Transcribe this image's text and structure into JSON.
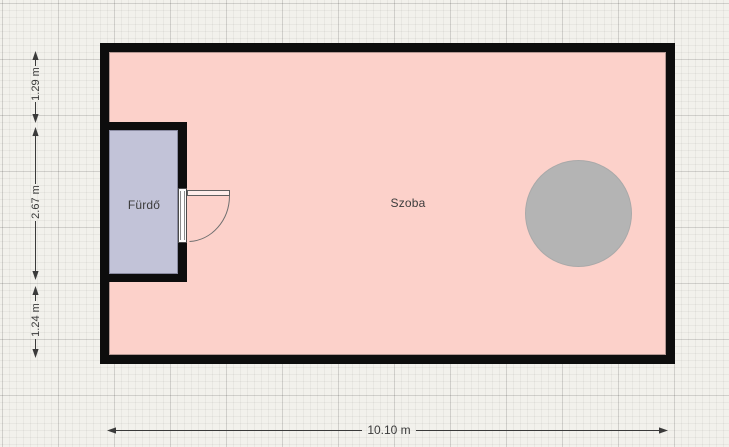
{
  "app": {
    "view": "floor-plan-canvas",
    "unit": "m"
  },
  "rooms": [
    {
      "id": "szoba",
      "label": "Szoba",
      "fill": "#fcd1ca"
    },
    {
      "id": "furdo",
      "label": "Fürdő",
      "fill": "#c2c3d8"
    }
  ],
  "furniture": [
    {
      "id": "round-table",
      "shape": "circle",
      "fill": "#b4b4b4"
    }
  ],
  "doors": [
    {
      "id": "bathroom-door",
      "wall": "bathroom-right-wall",
      "swing": "into-room"
    }
  ],
  "dimensions": [
    {
      "label": "1.29 m",
      "orientation": "vertical",
      "side": "left"
    },
    {
      "label": "2.67 m",
      "orientation": "vertical",
      "side": "left"
    },
    {
      "label": "1.24 m",
      "orientation": "vertical",
      "side": "left"
    },
    {
      "label": "10.10 m",
      "orientation": "horizontal",
      "side": "bottom"
    }
  ],
  "colors": {
    "canvas-bg": "#f2f1ec",
    "wall": "#0d0d0d",
    "room-fill": "#fcd1ca",
    "bathroom-fill": "#c2c3d8",
    "table-fill": "#b4b4b4",
    "dimension-line": "#3a3a3a",
    "label-text": "#3c3c3c"
  }
}
